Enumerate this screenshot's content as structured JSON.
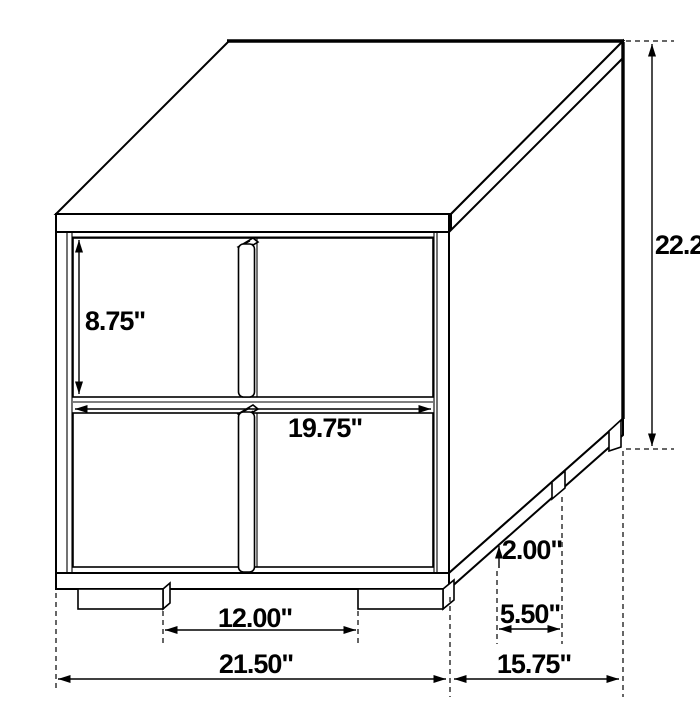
{
  "diagram": {
    "kind": "furniture-dimension-diagram",
    "subject": "two-drawer nightstand line drawing",
    "unit": "inches",
    "background_color": "#ffffff",
    "line_color": "#000000"
  },
  "labels": {
    "overall_height": "22.25\"",
    "drawer_height": "8.75\"",
    "opening_width": "19.75\"",
    "leg_height": "2.00\"",
    "side_leg_spacing": "5.50\"",
    "front_leg_spacing": "12.00\"",
    "overall_width": "21.50\"",
    "overall_depth": "15.75\""
  }
}
